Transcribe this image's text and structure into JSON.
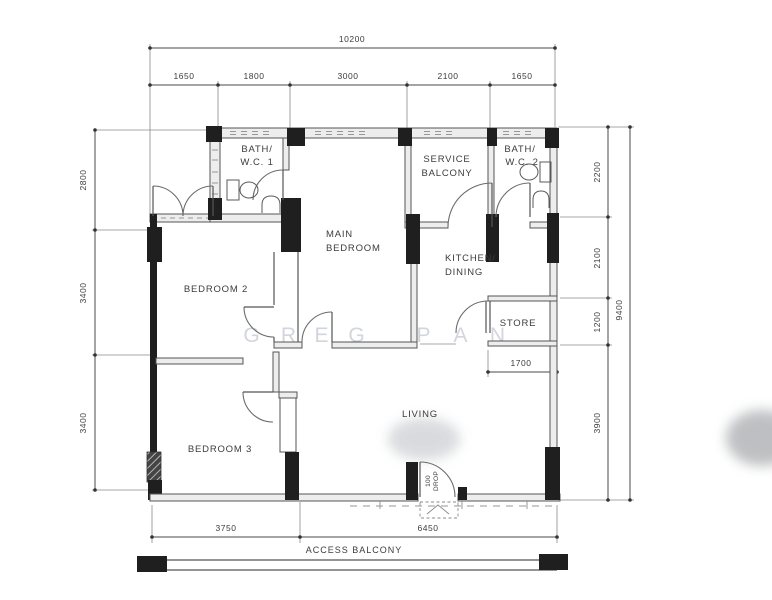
{
  "title": "apartment-floor-plan",
  "dims": {
    "top_total": "10200",
    "top_segments": [
      "1650",
      "1800",
      "3000",
      "2100",
      "1650"
    ],
    "left_segments": [
      "2800",
      "3400",
      "3400"
    ],
    "right_segments": [
      "2200",
      "2100",
      "1200",
      "3900"
    ],
    "right_total": "9400",
    "bottom_segments": [
      "3750",
      "6450"
    ],
    "store_width": "1700"
  },
  "rooms": {
    "bath1": [
      "BATH/",
      "W.C. 1"
    ],
    "service_balcony": [
      "SERVICE",
      "BALCONY"
    ],
    "bath2": [
      "BATH/",
      "W.C. 2"
    ],
    "main_bedroom": [
      "MAIN",
      "BEDROOM"
    ],
    "kitchen": [
      "KITCHEN/",
      "DINING"
    ],
    "bedroom2": "BEDROOM 2",
    "bedroom3": "BEDROOM 3",
    "store": "STORE",
    "living": "LIVING",
    "access_balcony": "ACCESS BALCONY"
  },
  "notes": {
    "drop": [
      "100",
      "DROP"
    ]
  },
  "watermark": {
    "letters": [
      "G",
      "R",
      "E",
      "G",
      "P",
      "A",
      "N"
    ]
  },
  "colors": {
    "line": "#555555",
    "pier": "#1f1f1f",
    "watermark": "#c9cfd8",
    "background": "#ffffff"
  }
}
